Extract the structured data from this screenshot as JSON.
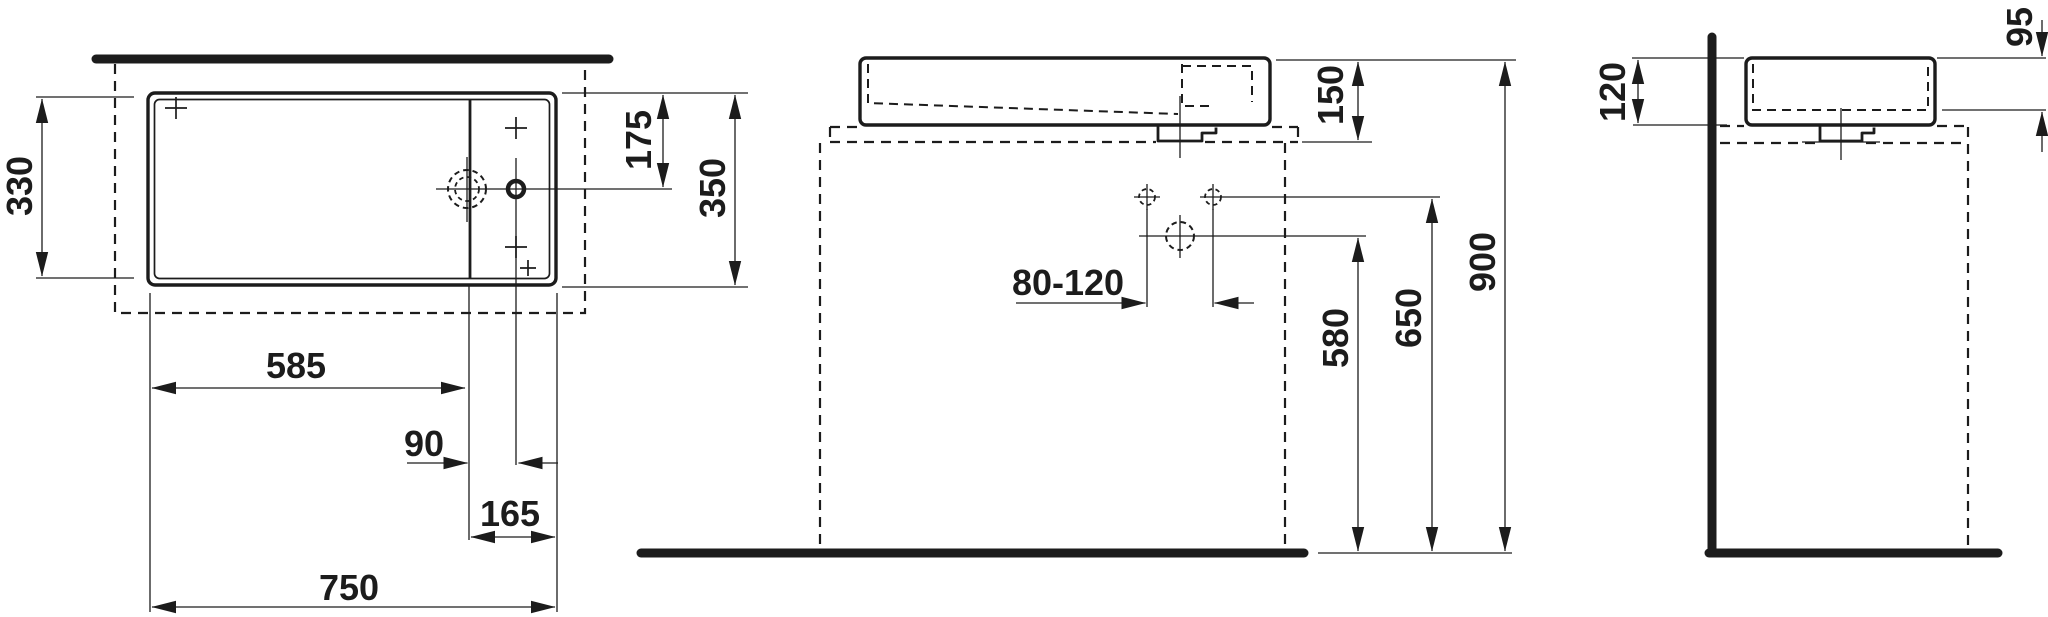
{
  "colors": {
    "ink": "#1c1c1c",
    "background": "#ffffff"
  },
  "views": {
    "top": {
      "dims": {
        "inner_depth": "330",
        "tap_centerline_offset": "175",
        "outer_depth": "350",
        "bowl_width": "585",
        "drain_to_tap": "90",
        "tap_deck_width": "165",
        "outer_width": "750"
      }
    },
    "front": {
      "dims": {
        "basin_height": "150",
        "tap_hole_spacing": "80-120",
        "waste_connection_height": "580",
        "supply_connection_height": "650",
        "rim_height": "900"
      }
    },
    "side": {
      "dims": {
        "body_height": "120",
        "bowl_inner_depth": "95"
      }
    }
  }
}
